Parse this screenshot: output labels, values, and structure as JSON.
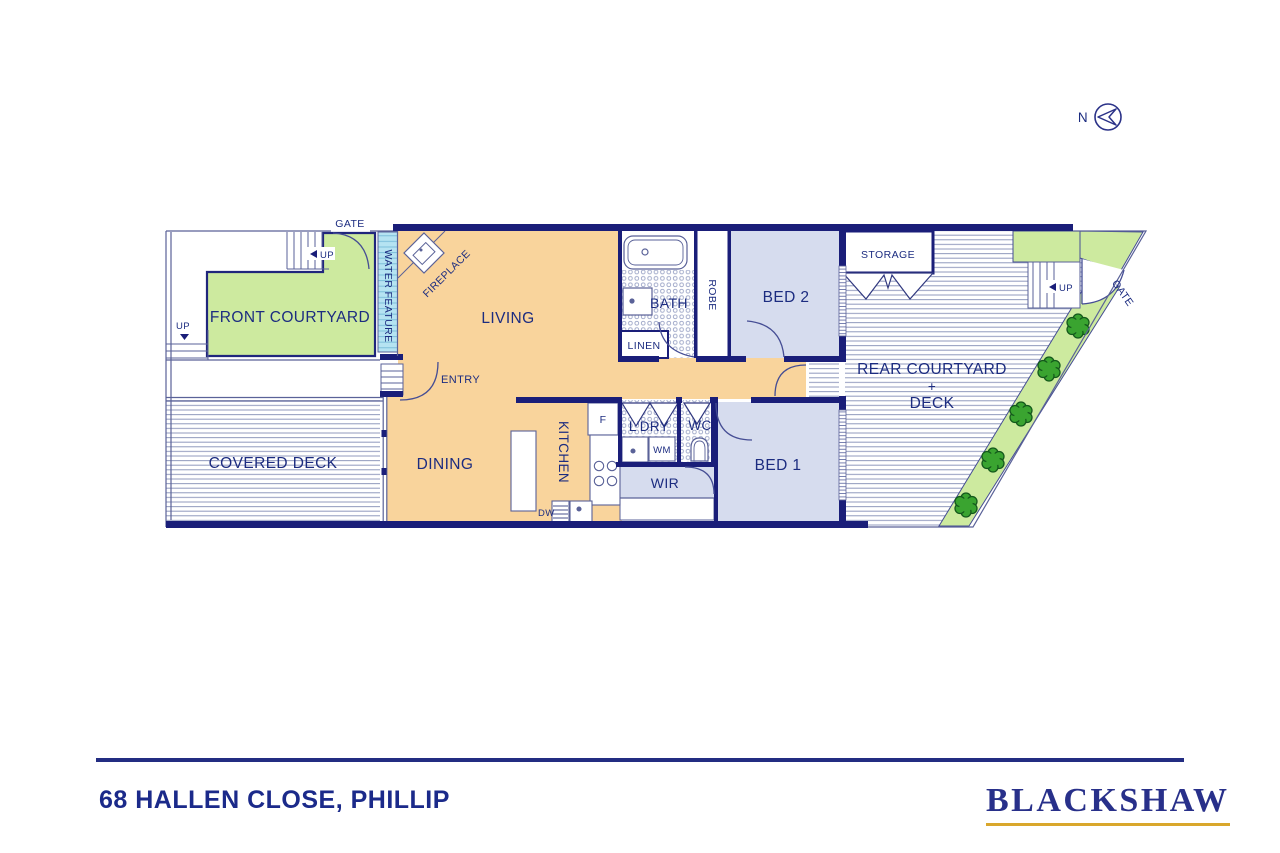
{
  "colors": {
    "wall_navy": "#1a1e79",
    "text_navy": "#1c2c80",
    "thin_line": "#5a6298",
    "floor_orange": "#f9d49c",
    "bedroom_lavender": "#d6dcee",
    "courtyard_green": "#cdea9f",
    "tree_green": "#3aa430",
    "water_blue": "#b5e3f2",
    "footer_navy": "#232d82",
    "brand_navy": "#28308a",
    "brand_gold": "#d9a72c"
  },
  "compass": {
    "north": "N"
  },
  "plan": {
    "labels": {
      "gate": "GATE",
      "up": "UP",
      "front_courtyard": "FRONT COURTYARD",
      "water_feature": "WATER FEATURE",
      "fireplace": "FIREPLACE",
      "living": "LIVING",
      "entry": "ENTRY",
      "bath": "BATH",
      "linen": "LINEN",
      "robe": "ROBE",
      "bed2": "BED 2",
      "storage": "STORAGE",
      "rear_courtyard": "REAR COURTYARD",
      "plus": "+",
      "deck": "DECK",
      "covered_deck": "COVERED DECK",
      "dining": "DINING",
      "kitchen": "KITCHEN",
      "fridge": "F",
      "laundry": "L'DRY",
      "washing_machine": "WM",
      "wc": "WC",
      "wir": "WIR",
      "bed1": "BED 1",
      "dishwasher": "DW"
    }
  },
  "footer": {
    "address": "68 HALLEN CLOSE, PHILLIP",
    "brand": "BLACKSHAW"
  }
}
